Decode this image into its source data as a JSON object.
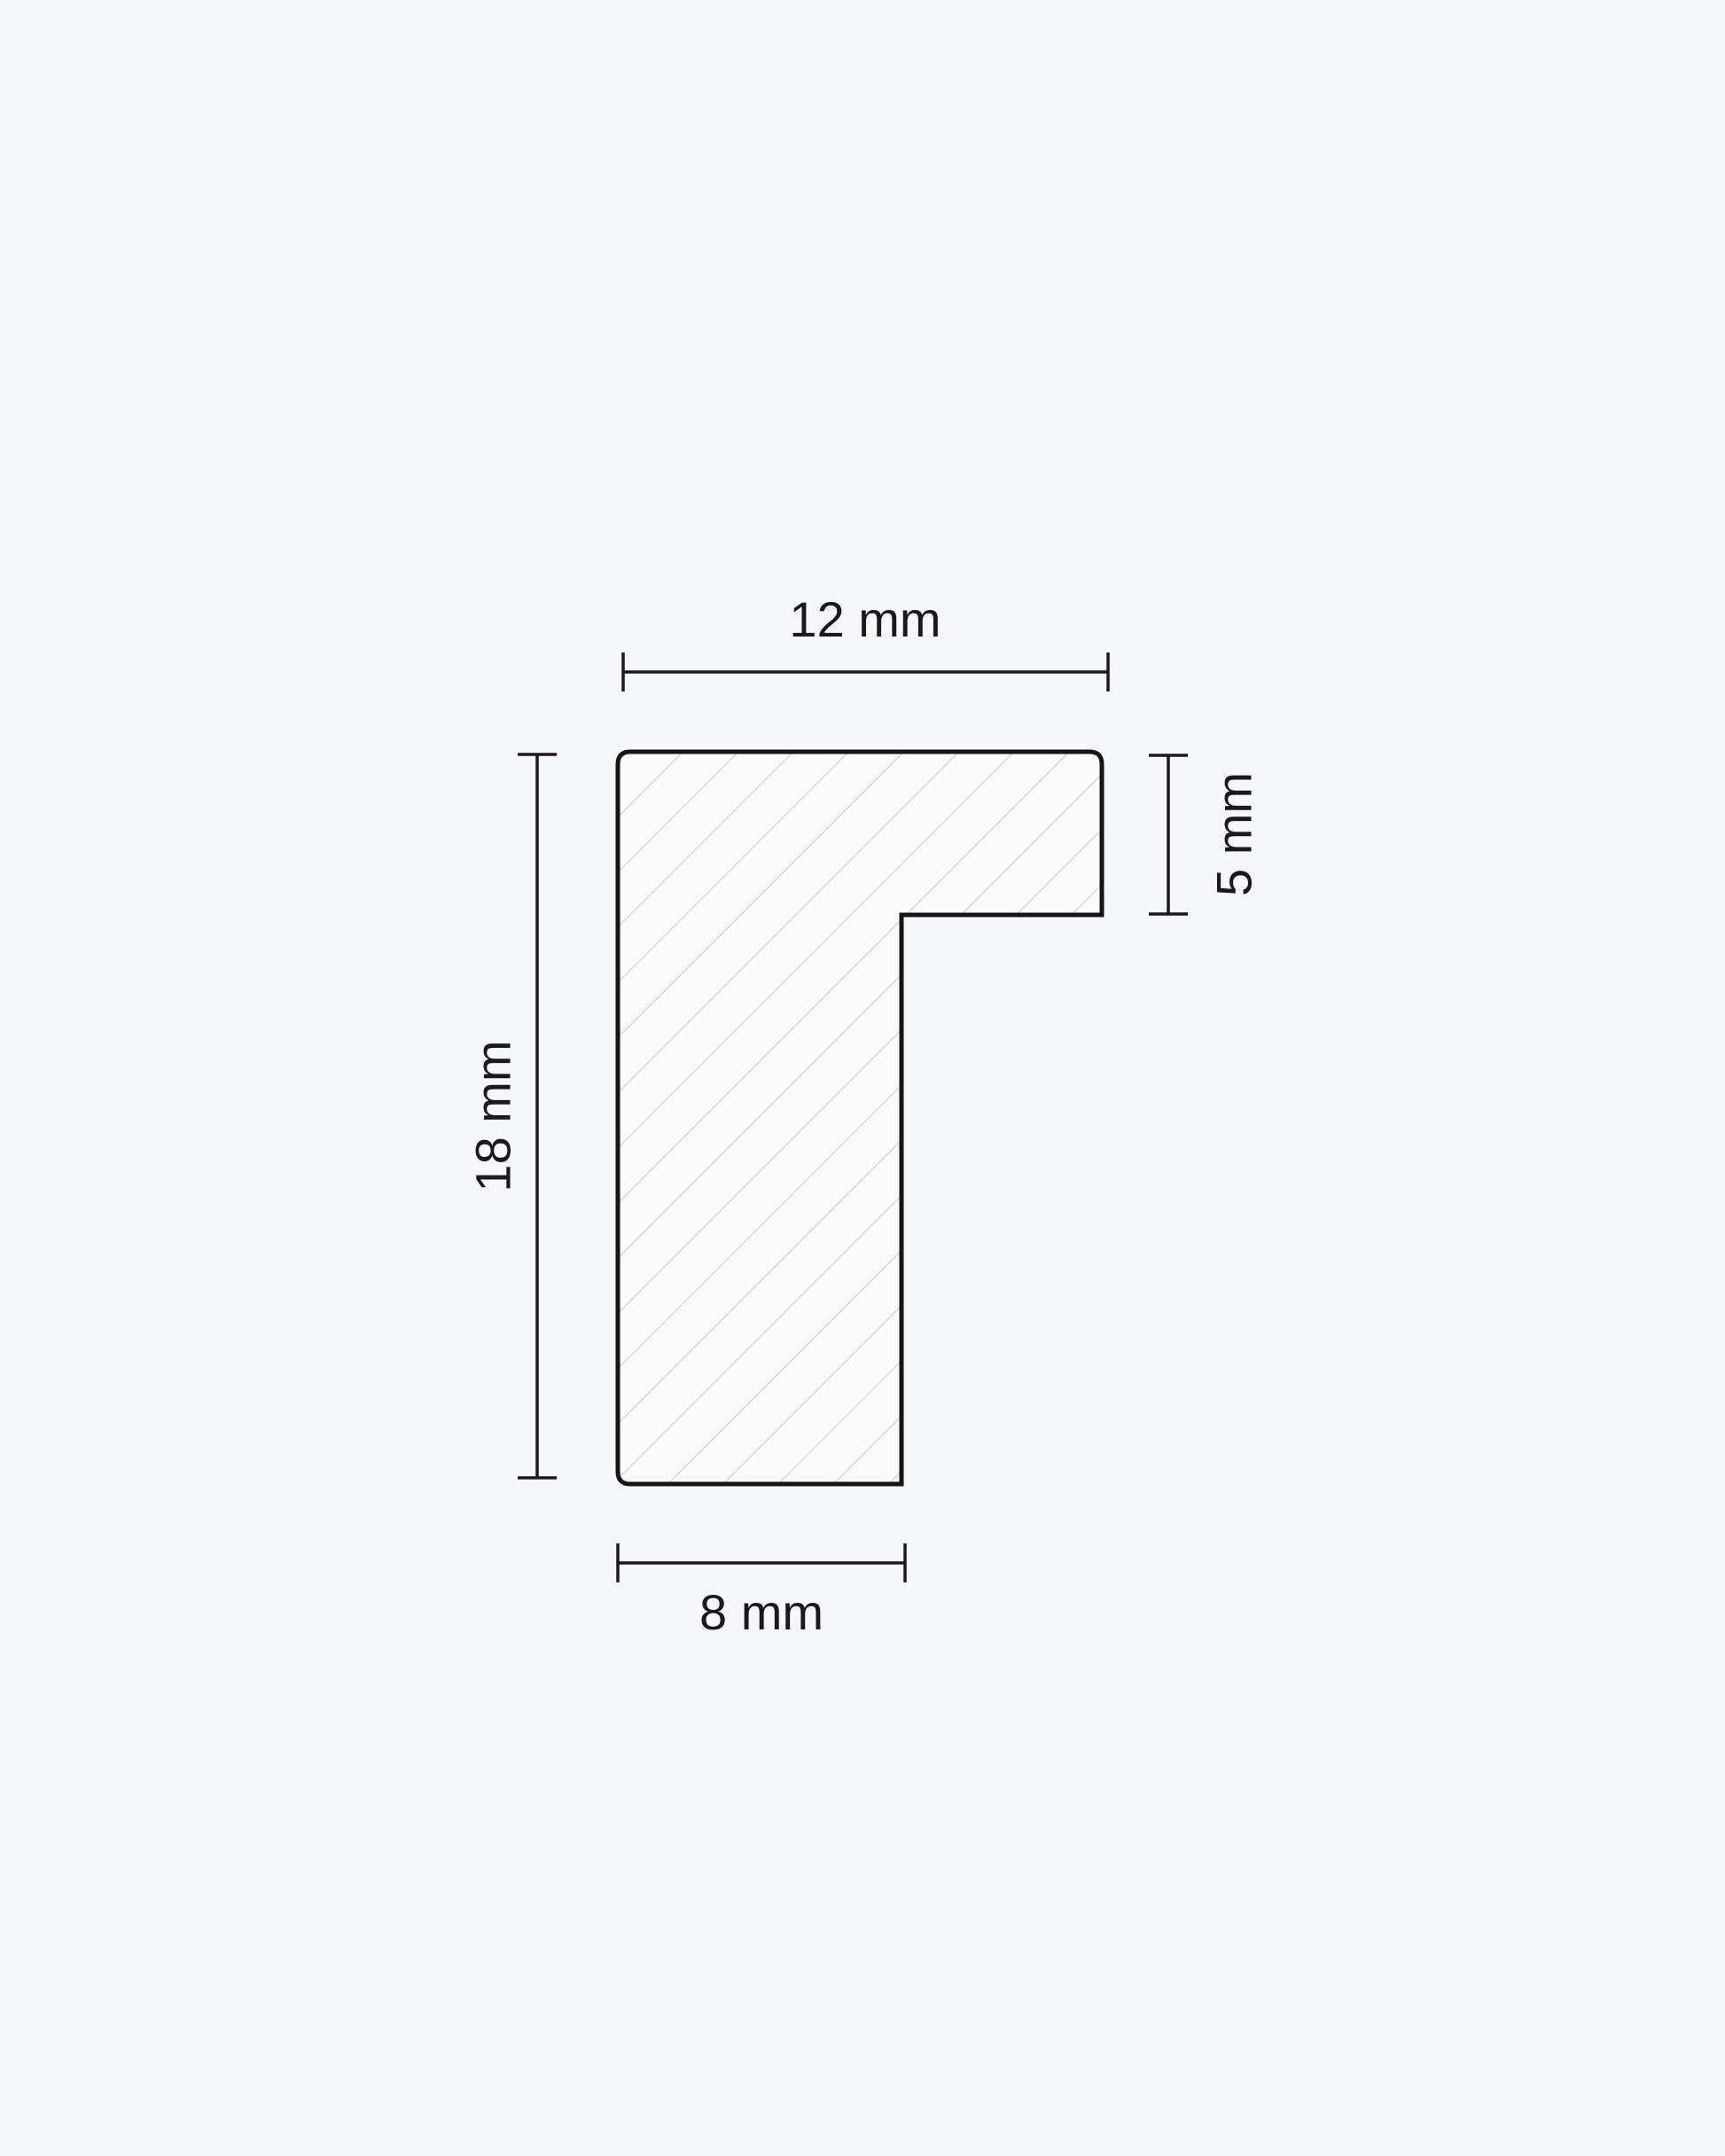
{
  "page": {
    "background_color": "#f6f7f9"
  },
  "drawing": {
    "kind": "frame-moulding-profile-cross-section",
    "shape_fill_color": "#fbfbfc",
    "outline_color": "#151517",
    "hatch_color": "#c6c8cc",
    "dimension_color": "#1a1a1c",
    "unit": "mm",
    "dimensions": {
      "top_width": {
        "label": "12 mm",
        "value": 12,
        "unit": "mm",
        "side": "top"
      },
      "left_height": {
        "label": "18 mm",
        "value": 18,
        "unit": "mm",
        "side": "left"
      },
      "right_rebate": {
        "label": "5 mm",
        "value": 5,
        "unit": "mm",
        "side": "right"
      },
      "bottom_width": {
        "label": "8 mm",
        "value": 8,
        "unit": "mm",
        "side": "bottom"
      }
    }
  }
}
